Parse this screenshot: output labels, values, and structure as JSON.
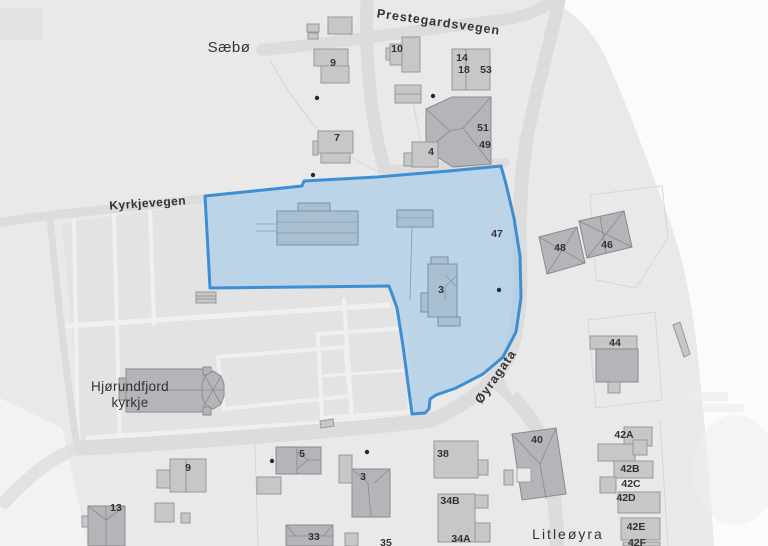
{
  "map": {
    "type": "cadastral-plan-map",
    "colors": {
      "land": "#e9e9e9",
      "cemetery": "#e3e3e3",
      "road": "#dcdcdc",
      "white_area": "#fbfbfb",
      "building_fill": "#c7c7ca",
      "building_dark_fill": "#b5b5b9",
      "building_in_parcel_fill": "#a9c0d3",
      "selection_fill": "#9cc6e8",
      "selection_stroke": "#3e8ed3",
      "label_color": "#333333",
      "poi_dot": "#2a2a2a"
    },
    "selected_parcel": {
      "house_numbers_inside": [
        "3",
        "47"
      ]
    },
    "place_labels": [
      {
        "text": "Sæbø",
        "x": 229,
        "y": 52,
        "size": 15,
        "weight": 400,
        "spacing": 0.5,
        "rot": 0
      },
      {
        "lines": [
          "Hjørundfjord",
          "kyrkje"
        ],
        "x": 130,
        "y": 391,
        "size": 13.5,
        "weight": 400,
        "spacing": 0.3,
        "rot": 0,
        "lineHeight": 16
      },
      {
        "text": "Litleøyra",
        "x": 568,
        "y": 539,
        "size": 14,
        "weight": 400,
        "spacing": 2,
        "rot": 0
      }
    ],
    "street_labels": [
      {
        "text": "Prestegardsvegen",
        "x": 438,
        "y": 26,
        "size": 12.5,
        "weight": 600,
        "spacing": 1,
        "rot": 8
      },
      {
        "text": "Kyrkjevegen",
        "x": 148,
        "y": 207,
        "size": 12,
        "weight": 600,
        "spacing": 0.5,
        "rot": -4
      },
      {
        "text": "Øyragata",
        "x": 499,
        "y": 379,
        "size": 12.5,
        "weight": 700,
        "spacing": 1,
        "rot": -55
      }
    ],
    "house_numbers": [
      {
        "text": "9",
        "x": 333,
        "y": 66
      },
      {
        "text": "10",
        "x": 397,
        "y": 52
      },
      {
        "text": "14",
        "x": 462,
        "y": 61
      },
      {
        "text": "18",
        "x": 464,
        "y": 73
      },
      {
        "text": "53",
        "x": 486,
        "y": 73
      },
      {
        "text": "7",
        "x": 337,
        "y": 141
      },
      {
        "text": "4",
        "x": 431,
        "y": 155
      },
      {
        "text": "51",
        "x": 483,
        "y": 131
      },
      {
        "text": "49",
        "x": 485,
        "y": 148
      },
      {
        "text": "47",
        "x": 497,
        "y": 237
      },
      {
        "text": "48",
        "x": 560,
        "y": 251
      },
      {
        "text": "46",
        "x": 607,
        "y": 248
      },
      {
        "text": "3",
        "x": 441,
        "y": 293
      },
      {
        "text": "44",
        "x": 615,
        "y": 346
      },
      {
        "text": "40",
        "x": 537,
        "y": 443
      },
      {
        "text": "42A",
        "x": 624,
        "y": 438
      },
      {
        "text": "42B",
        "x": 630,
        "y": 472
      },
      {
        "text": "42C",
        "x": 631,
        "y": 487
      },
      {
        "text": "42D",
        "x": 626,
        "y": 501
      },
      {
        "text": "42E",
        "x": 636,
        "y": 530
      },
      {
        "text": "42F",
        "x": 637,
        "y": 546
      },
      {
        "text": "38",
        "x": 443,
        "y": 457
      },
      {
        "text": "34B",
        "x": 450,
        "y": 504
      },
      {
        "text": "34A",
        "x": 461,
        "y": 542
      },
      {
        "text": "5",
        "x": 302,
        "y": 457
      },
      {
        "text": "9",
        "x": 188,
        "y": 471
      },
      {
        "text": "3",
        "x": 363,
        "y": 480
      },
      {
        "text": "13",
        "x": 116,
        "y": 511
      },
      {
        "text": "33",
        "x": 314,
        "y": 540
      },
      {
        "text": "35",
        "x": 386,
        "y": 546
      }
    ],
    "poi_dots": [
      {
        "x": 317,
        "y": 98
      },
      {
        "x": 433,
        "y": 96
      },
      {
        "x": 313,
        "y": 175
      },
      {
        "x": 499,
        "y": 290
      },
      {
        "x": 272,
        "y": 461
      },
      {
        "x": 367,
        "y": 452
      }
    ]
  }
}
